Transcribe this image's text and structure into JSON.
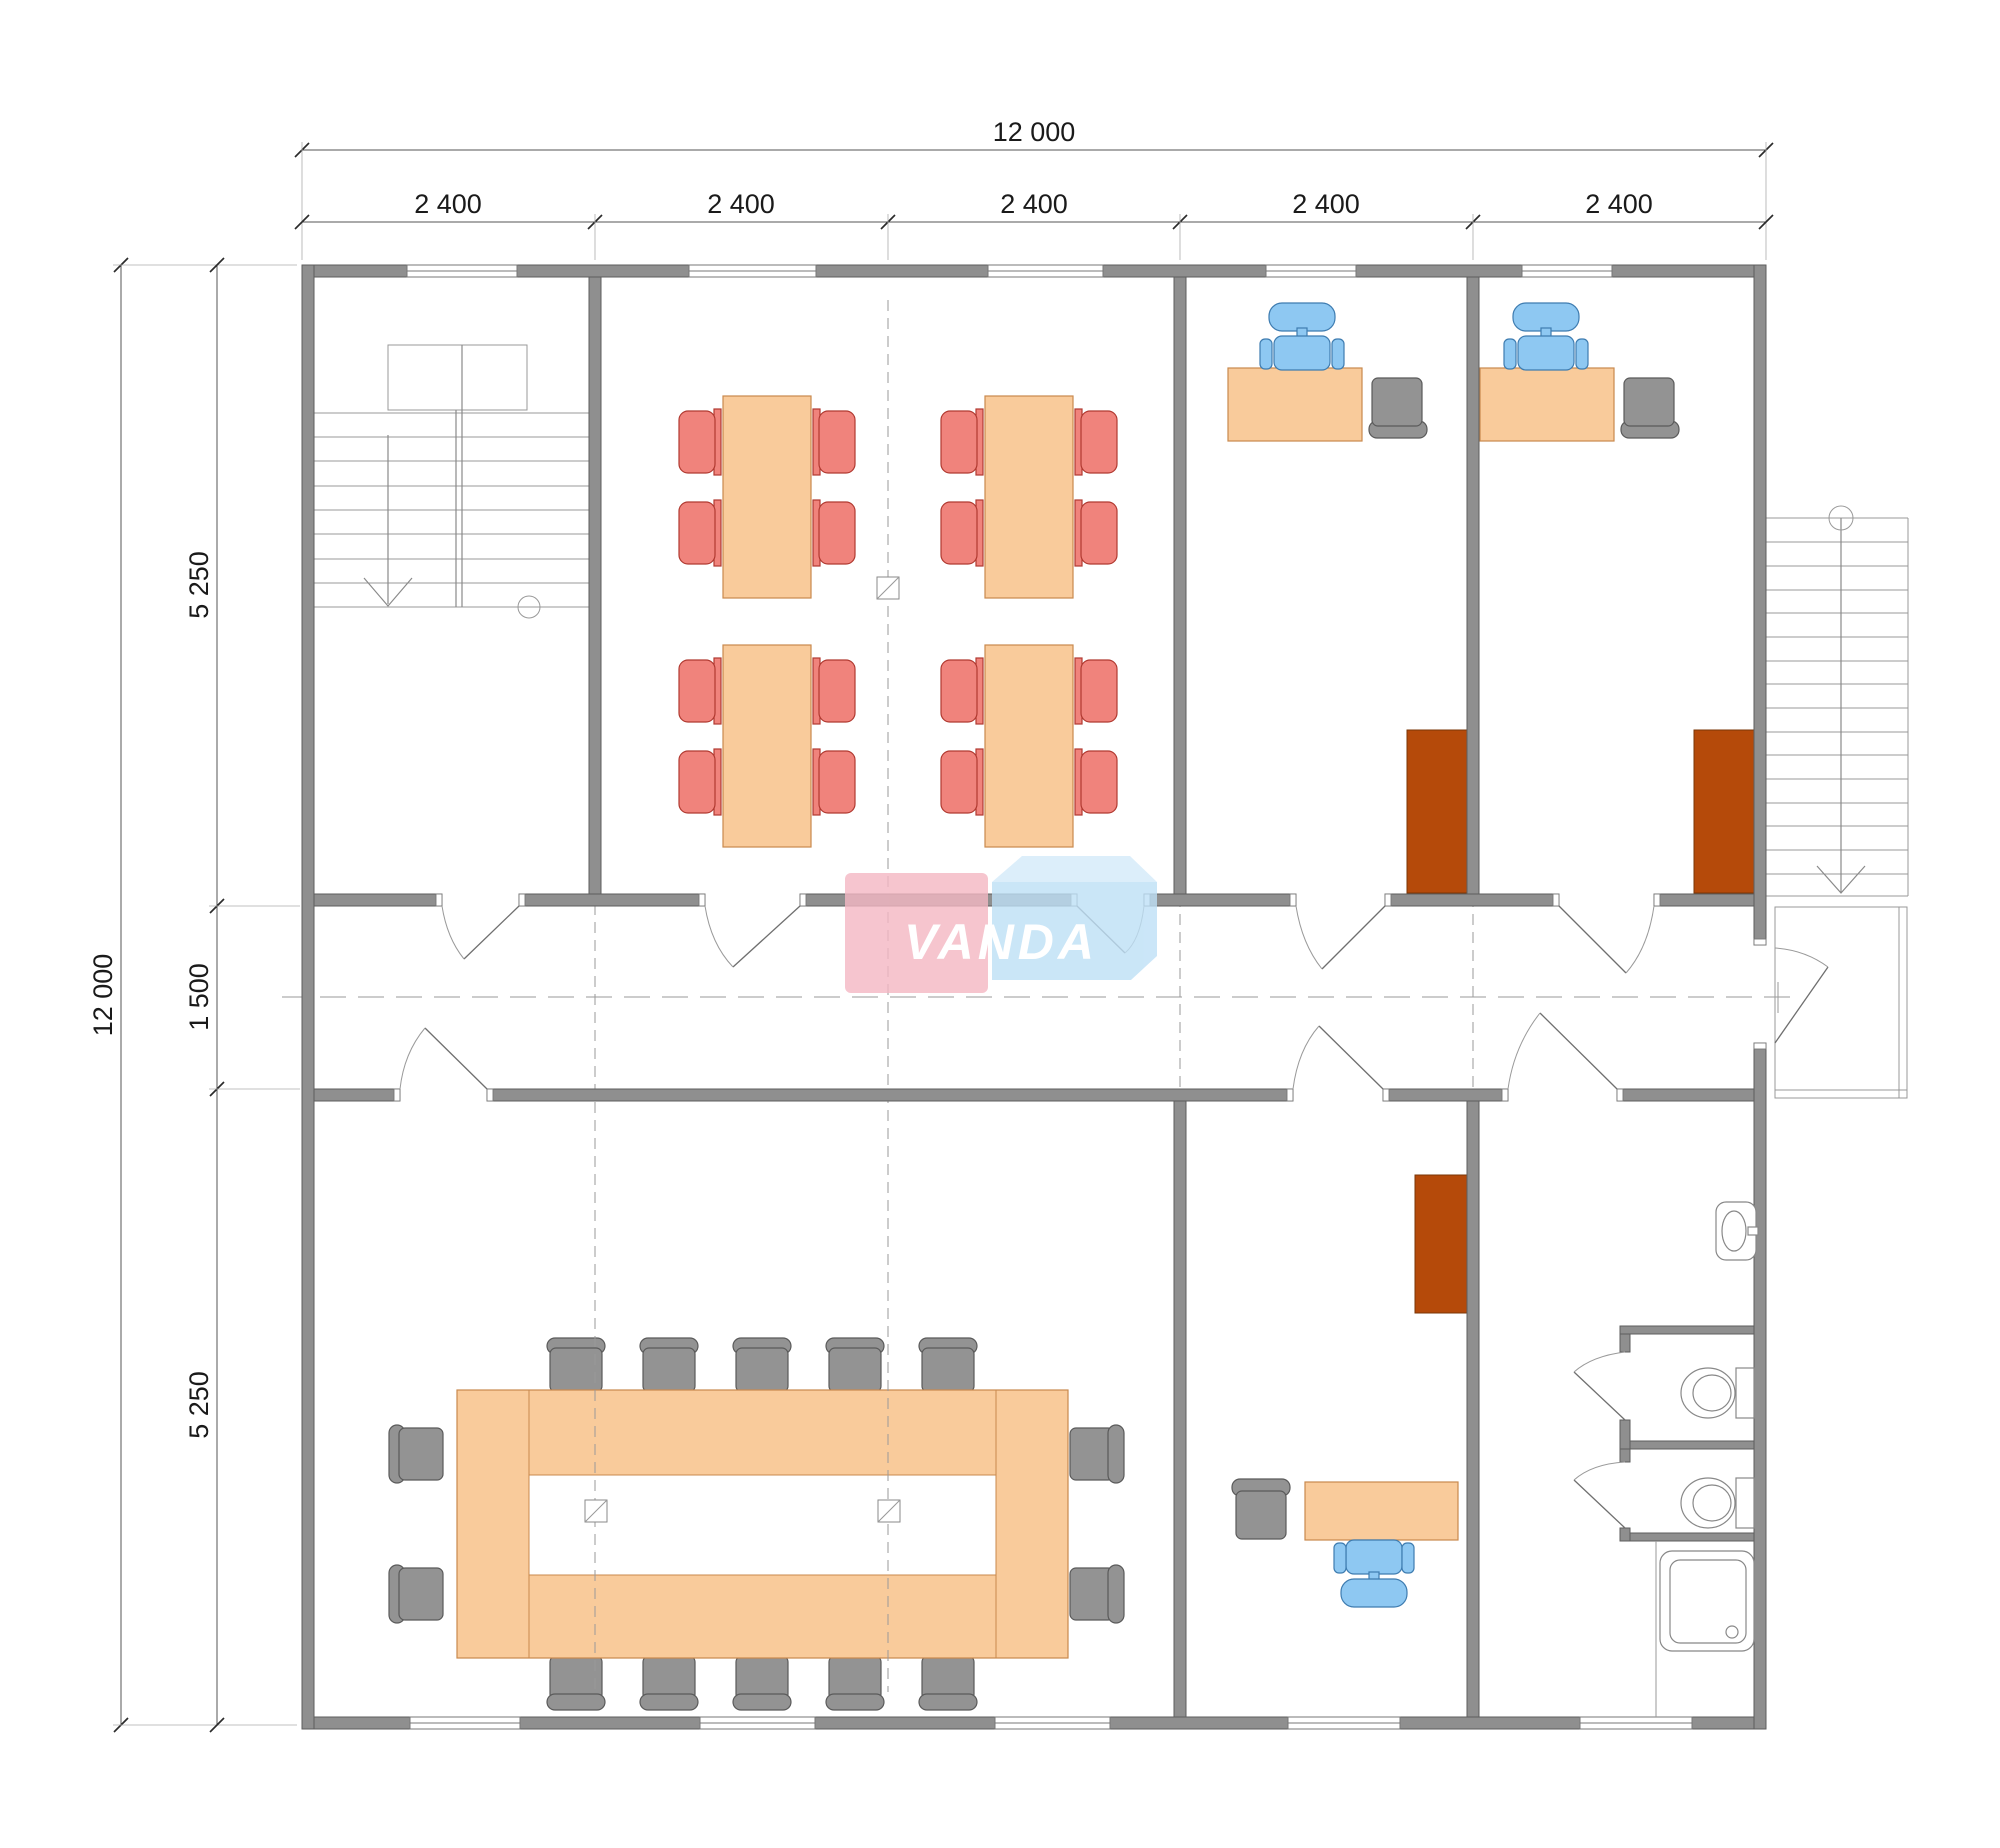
{
  "plan": {
    "logo": {
      "text": "VANDA"
    },
    "dimensions": {
      "top_total": "12 000",
      "top_bays": [
        "2 400",
        "2 400",
        "2 400",
        "2 400",
        "2 400"
      ],
      "left_total": "12 000",
      "left_top": "5 250",
      "left_middle": "1 500",
      "left_bottom": "5 250"
    },
    "colors": {
      "wall": "#8F8F8F",
      "wall_outline": "#5E5E5E",
      "furniture_wood": "#F9CB9B",
      "chair_red": "#F0837C",
      "chair_blue": "#8EC8F2",
      "chair_gray": "#939393",
      "cabinet_brown": "#B54A0A",
      "logo_pink": "#F4B7C3",
      "logo_blue": "#BEE0F6",
      "logo_blue_top": "#D4EBFA"
    },
    "inventory": {
      "classroom_tables": 4,
      "classroom_chairs": 16,
      "office_desks": 3,
      "office_chairs_blue": 3,
      "guest_chairs_gray": 3,
      "cabinets": 3,
      "conference_chairs": 14,
      "toilets": 2,
      "sinks": 1,
      "showers": 1,
      "staircases": 2
    }
  }
}
